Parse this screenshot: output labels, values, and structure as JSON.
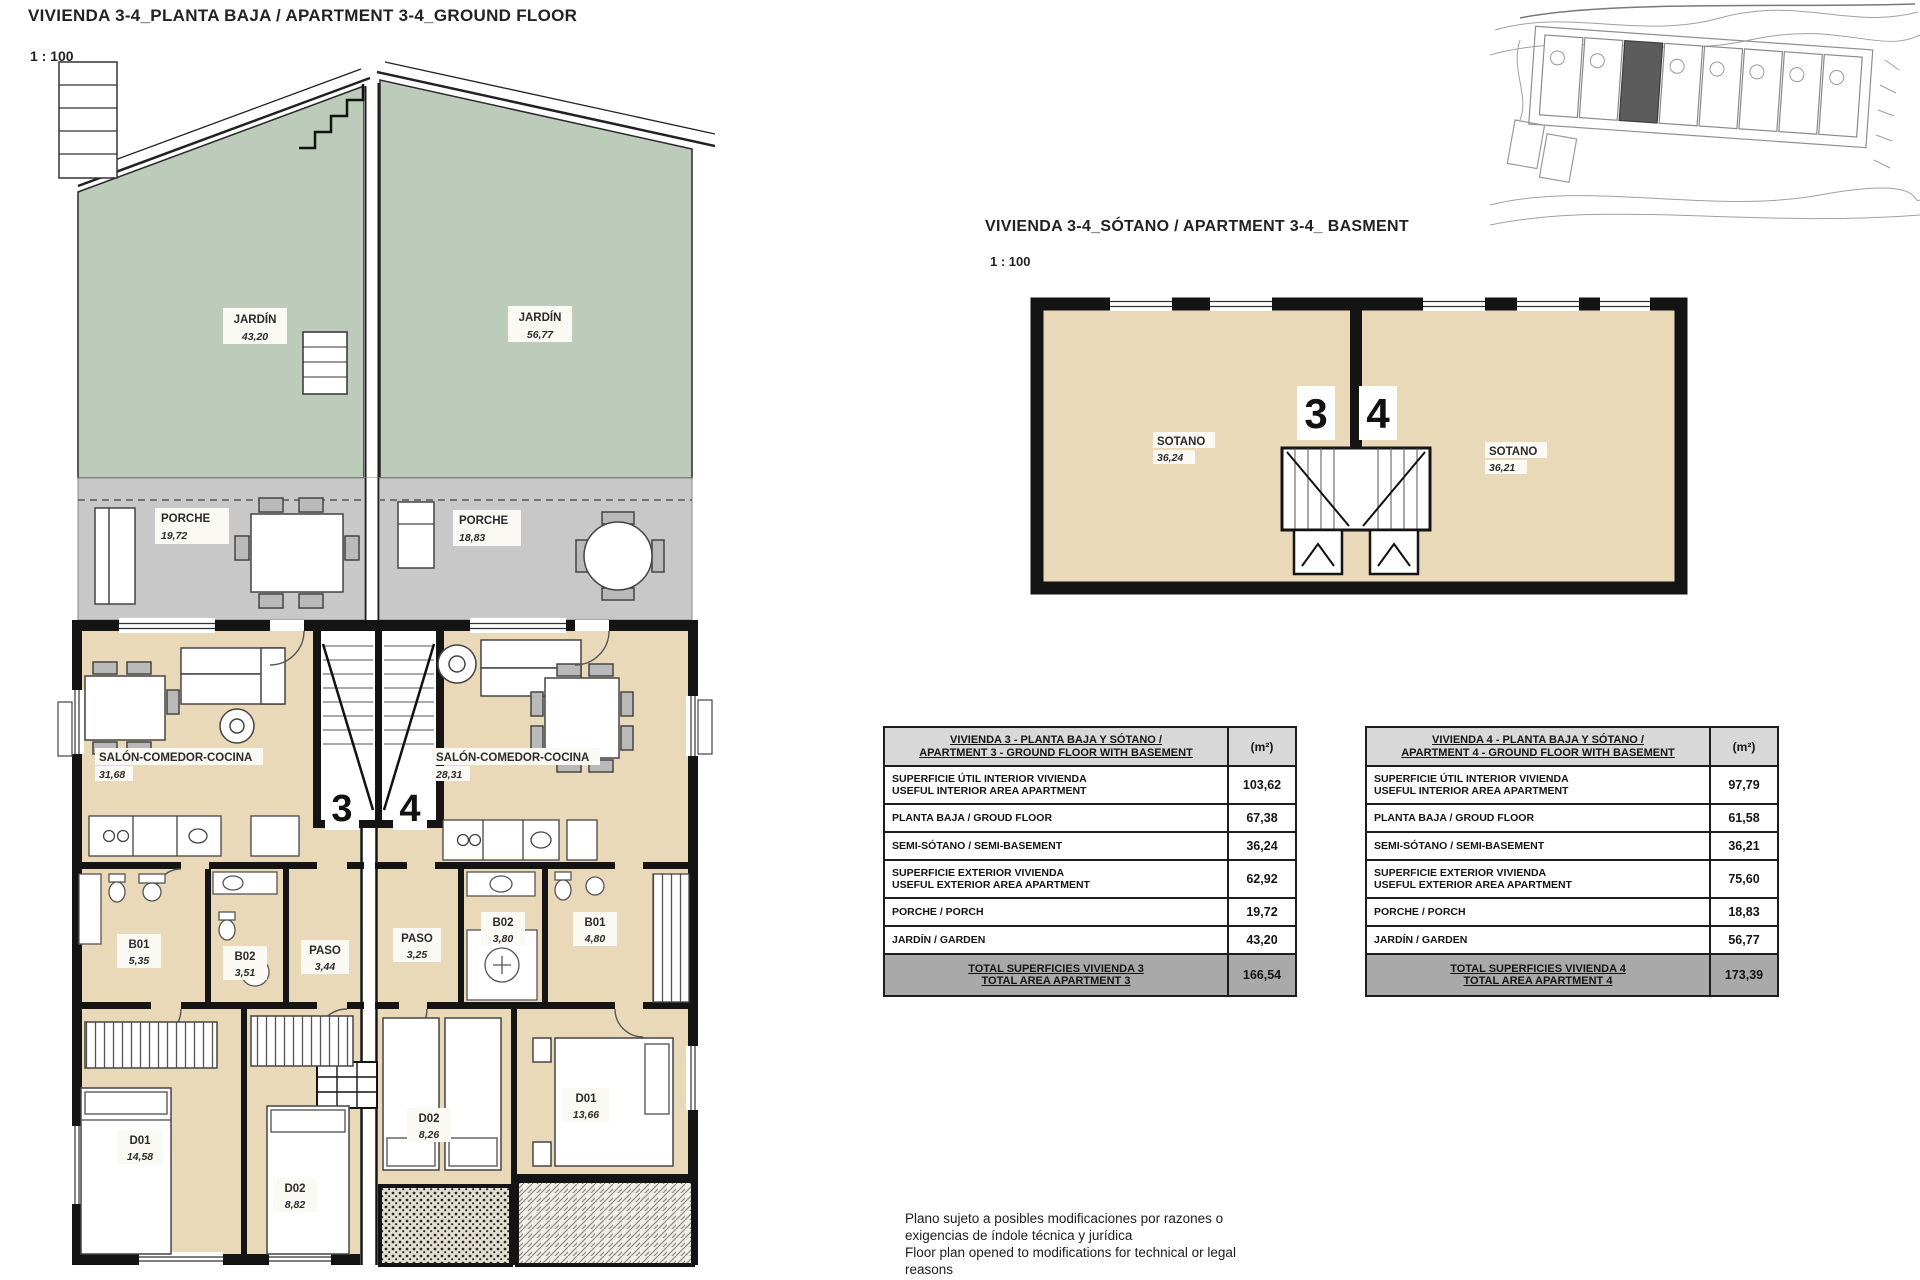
{
  "header": {
    "title": "VIVIENDA 3-4_PLANTA BAJA / APARTMENT 3-4_GROUND FLOOR",
    "scale": "1 : 100"
  },
  "basement": {
    "title": "VIVIENDA 3-4_SÓTANO / APARTMENT 3-4_ BASMENT",
    "scale": "1 : 100",
    "left_number": "3",
    "right_number": "4",
    "left_room": {
      "name": "SOTANO",
      "area": "36,24"
    },
    "right_room": {
      "name": "SOTANO",
      "area": "36,21"
    }
  },
  "ground_plan": {
    "left_number": "3",
    "right_number": "4",
    "garden_left": {
      "name": "JARDÍN",
      "area": "43,20"
    },
    "garden_right": {
      "name": "JARDÍN",
      "area": "56,77"
    },
    "porch_left": {
      "name": "PORCHE",
      "area": "19,72"
    },
    "porch_right": {
      "name": "PORCHE",
      "area": "18,83"
    },
    "salon_left": {
      "name": "SALÓN-COMEDOR-COCINA",
      "area": "31,68"
    },
    "salon_right": {
      "name": "SALÓN-COMEDOR-COCINA",
      "area": "28,31"
    },
    "left_rooms": {
      "b01": {
        "name": "B01",
        "area": "5,35"
      },
      "b02": {
        "name": "B02",
        "area": "3,51"
      },
      "paso": {
        "name": "PASO",
        "area": "3,44"
      },
      "d01": {
        "name": "D01",
        "area": "14,58"
      },
      "d02": {
        "name": "D02",
        "area": "8,82"
      }
    },
    "right_rooms": {
      "paso": {
        "name": "PASO",
        "area": "3,25"
      },
      "b02": {
        "name": "B02",
        "area": "3,80"
      },
      "b01": {
        "name": "B01",
        "area": "4,80"
      },
      "d02": {
        "name": "D02",
        "area": "8,26"
      },
      "d01": {
        "name": "D01",
        "area": "13,66"
      }
    }
  },
  "tables": [
    {
      "header_line1": "VIVIENDA 3 - PLANTA BAJA Y SÓTANO /",
      "header_line2": "APARTMENT 3 - GROUND FLOOR WITH BASEMENT",
      "unit": "(m²)",
      "rows": [
        {
          "l1": "SUPERFICIE ÚTIL INTERIOR VIVIENDA",
          "l2": "USEFUL INTERIOR AREA APARTMENT",
          "v": "103,62"
        },
        {
          "l1": "PLANTA BAJA / GROUD FLOOR",
          "v": "67,38"
        },
        {
          "l1": "SEMI-SÓTANO / SEMI-BASEMENT",
          "v": "36,24"
        },
        {
          "l1": "SUPERFICIE EXTERIOR VIVIENDA",
          "l2": "USEFUL EXTERIOR AREA APARTMENT",
          "v": "62,92"
        },
        {
          "l1": "PORCHE / PORCH",
          "v": "19,72"
        },
        {
          "l1": "JARDÍN / GARDEN",
          "v": "43,20"
        }
      ],
      "total_line1": "TOTAL SUPERFICIES VIVIENDA 3",
      "total_line2": "TOTAL AREA APARTMENT 3",
      "total_value": "166,54"
    },
    {
      "header_line1": "VIVIENDA 4 - PLANTA BAJA Y SÓTANO /",
      "header_line2": "APARTMENT 4 - GROUND FLOOR WITH BASEMENT",
      "unit": "(m²)",
      "rows": [
        {
          "l1": "SUPERFICIE ÚTIL INTERIOR VIVIENDA",
          "l2": "USEFUL INTERIOR AREA APARTMENT",
          "v": "97,79"
        },
        {
          "l1": "PLANTA BAJA / GROUD FLOOR",
          "v": "61,58"
        },
        {
          "l1": "SEMI-SÓTANO / SEMI-BASEMENT",
          "v": "36,21"
        },
        {
          "l1": "SUPERFICIE EXTERIOR VIVIENDA",
          "l2": "USEFUL EXTERIOR AREA APARTMENT",
          "v": "75,60"
        },
        {
          "l1": "PORCHE / PORCH",
          "v": "18,83"
        },
        {
          "l1": "JARDÍN / GARDEN",
          "v": "56,77"
        }
      ],
      "total_line1": "TOTAL SUPERFICIES VIVIENDA 4",
      "total_line2": "TOTAL AREA APARTMENT 4",
      "total_value": "173,39"
    }
  ],
  "footnote": {
    "line1": "Plano sujeto a posibles modificaciones por razones o",
    "line2": "exigencias de índole técnica y jurídica",
    "line3": "Floor plan opened to modifications for technical or legal",
    "line4": "reasons"
  }
}
